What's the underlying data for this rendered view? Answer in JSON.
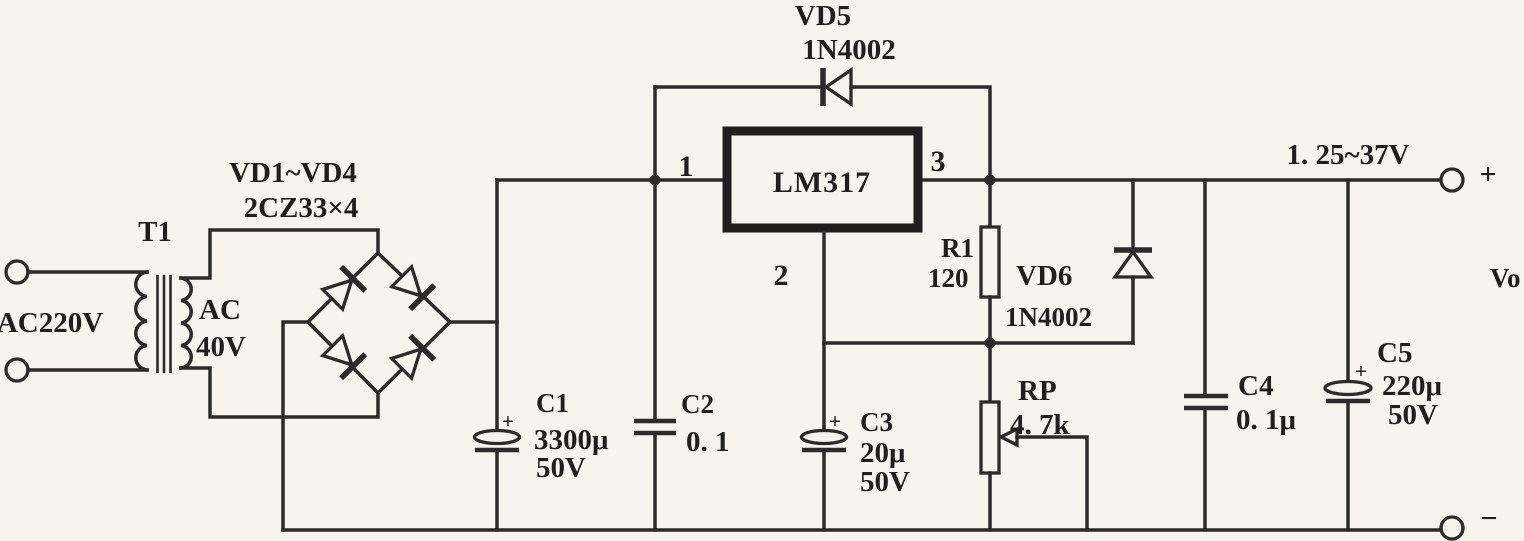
{
  "colors": {
    "paper": "#f5f4ef",
    "ink": "#2b2b2b"
  },
  "io": {
    "input_label": "AC220V",
    "output_range": "1. 25~37V",
    "output_name": "Vo",
    "plus": "+",
    "minus": "−"
  },
  "components": {
    "transformer": {
      "ref": "T1",
      "secondary_line1": "AC",
      "secondary_line2": "40V"
    },
    "bridge": {
      "ref": "VD1~VD4",
      "part": "2CZ33×4"
    },
    "regulator": {
      "part": "LM317",
      "pin_input": "1",
      "pin_adjust": "2",
      "pin_output": "3"
    },
    "vd5": {
      "ref": "VD5",
      "part": "1N4002"
    },
    "vd6": {
      "ref": "VD6",
      "part": "1N4002"
    },
    "r1": {
      "ref": "R1",
      "value": "120"
    },
    "rp": {
      "ref": "RP",
      "value": "4. 7k"
    },
    "c1": {
      "ref": "C1",
      "value": "3300μ",
      "voltage": "50V",
      "polarity": "+"
    },
    "c2": {
      "ref": "C2",
      "value": "0. 1"
    },
    "c3": {
      "ref": "C3",
      "value": "20μ",
      "voltage": "50V",
      "polarity": "+"
    },
    "c4": {
      "ref": "C4",
      "value": "0. 1μ"
    },
    "c5": {
      "ref": "C5",
      "value": "220μ",
      "voltage": "50V",
      "polarity": "+"
    }
  }
}
